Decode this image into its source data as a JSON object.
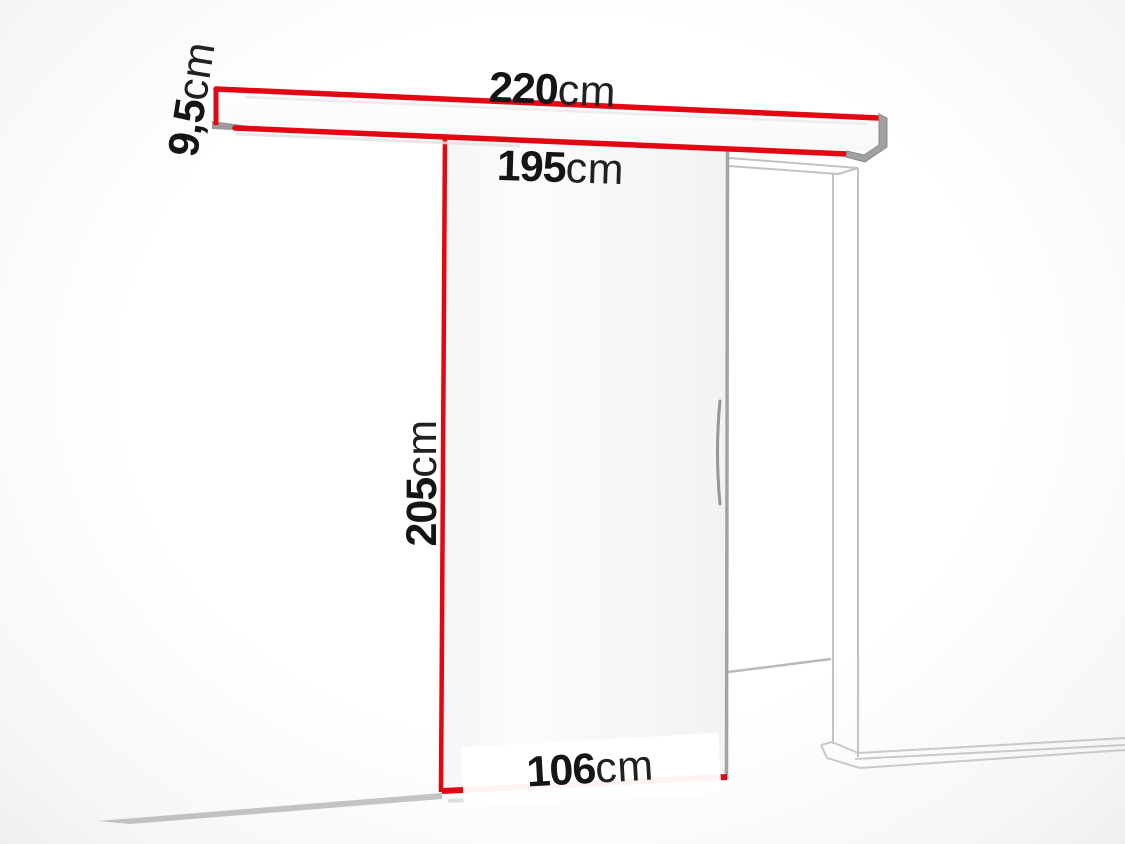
{
  "page": {
    "title": "Sliding door system dimension diagram"
  },
  "diagram": {
    "accent_color": "#e30613",
    "frame_line_color": "#c9c9c9",
    "shadow_line_color": "#b9b9b9",
    "metal_cap_color": "#9f9f9f",
    "dimensions": {
      "track_length": {
        "value": "220",
        "unit": "cm"
      },
      "track_height": {
        "value": "9,5",
        "unit": "cm"
      },
      "inner_width": {
        "value": "195",
        "unit": "cm"
      },
      "door_height": {
        "value": "205",
        "unit": "cm"
      },
      "door_width": {
        "value": "106",
        "unit": "cm"
      }
    }
  }
}
